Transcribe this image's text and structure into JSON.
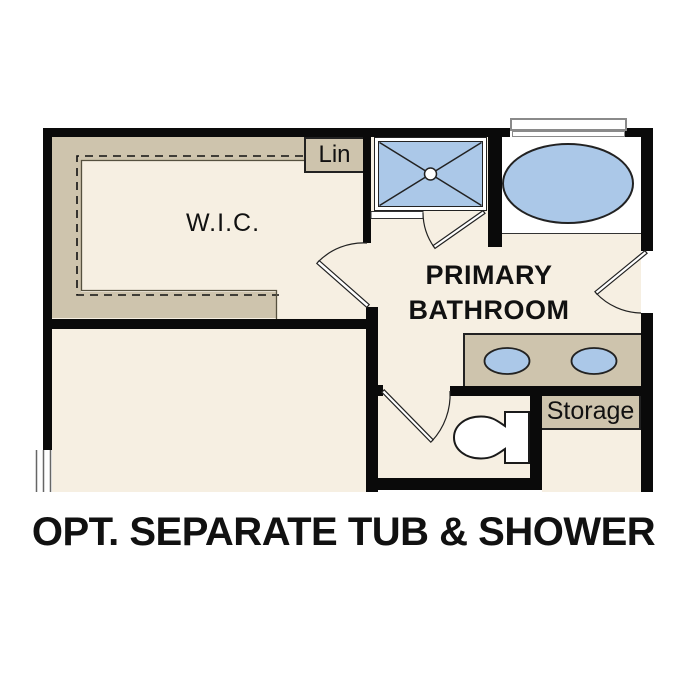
{
  "caption": {
    "text": "OPT. SEPARATE TUB & SHOWER"
  },
  "rooms": {
    "wic": {
      "label": "W.I.C."
    },
    "primary_bathroom": {
      "label_line1": "PRIMARY",
      "label_line2": "BATHROOM"
    },
    "linen_closet": {
      "label": "Lin"
    },
    "storage": {
      "label": "Storage"
    }
  },
  "fixtures": {
    "shower": "walk-in-shower-with-center-drain",
    "tub": "oval-soaking-tub",
    "vanity": "double-sink-vanity",
    "sinks": [
      "vanity-sink-left",
      "vanity-sink-right"
    ],
    "toilet": "toilet",
    "doors": [
      "wic-door",
      "shower-door",
      "toilet-room-door",
      "bathroom-entry-door"
    ],
    "windows": [
      "window-above-tub",
      "window-bedroom-left"
    ],
    "closet_rods": "wic-hanging-rod-dashed"
  },
  "palette": {
    "floor": "#f6efe2",
    "casework": "#cec4ad",
    "fixture_fill": "#abc8e8",
    "wall": "#0a0a0a",
    "thin_line": "#333333",
    "window_frame": "#8a8a8a",
    "text": "#111111"
  }
}
